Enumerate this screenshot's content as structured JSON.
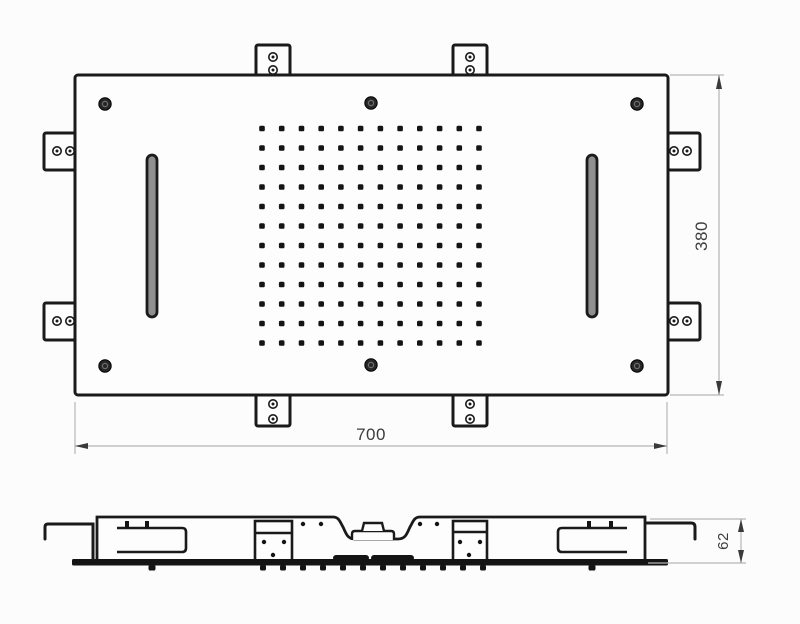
{
  "dimensions": {
    "width": {
      "label": "700"
    },
    "height": {
      "label": "380"
    },
    "depth": {
      "label": "62"
    }
  },
  "top_view": {
    "spray_grid": {
      "rows": 12,
      "cols": 12
    },
    "screw_count": 6,
    "mounting_tabs": {
      "top": 2,
      "bottom": 2,
      "left": 2,
      "right": 2
    },
    "slot_count": 2
  },
  "side_view": {
    "nozzle_tick_count": 12,
    "slot_nozzle_count": 2,
    "bracket_section_count": 2
  },
  "colors": {
    "background": "#fcfcfc",
    "line": "#1a1a1a",
    "fill": "#fdfdfd",
    "dim_line": "#b5b5b5",
    "arrow": "#3a3a3a",
    "text": "#3c3c3c",
    "dot": "#141414",
    "slot_fill": "#8f8f8f"
  }
}
